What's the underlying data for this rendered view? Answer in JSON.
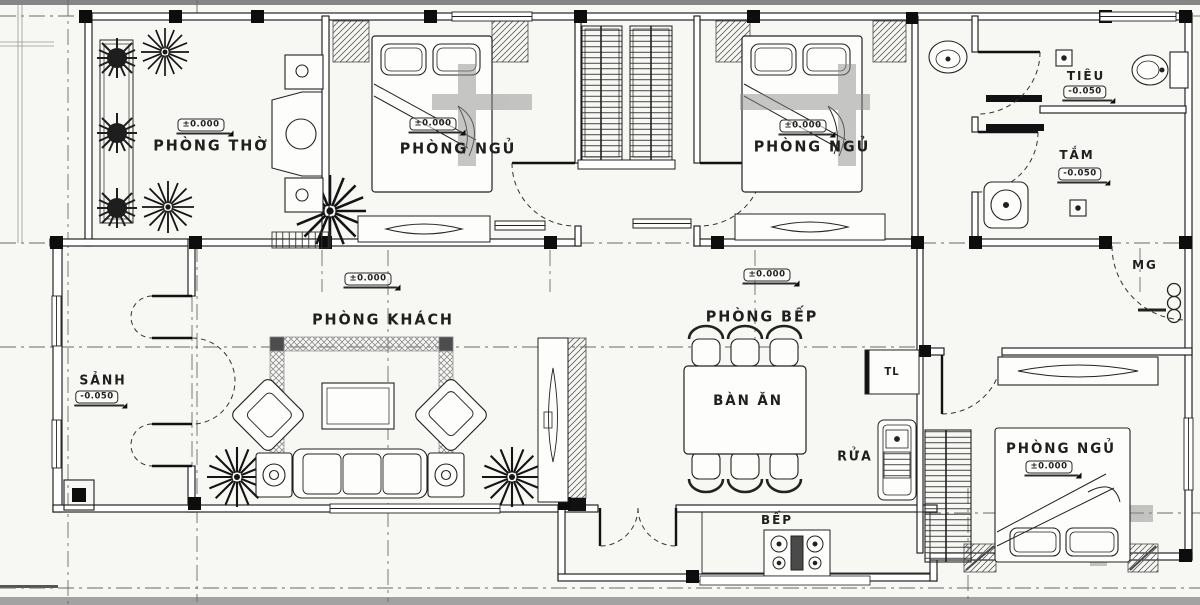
{
  "drawing": {
    "type": "house-floor-plan",
    "colors": {
      "ink": "#1c1c1c",
      "paper": "#f7f7f4",
      "band_top": "#858585",
      "band_bottom": "#a2a2a2",
      "hatch": "#666666",
      "shadow_band": "#8f8f8f"
    }
  },
  "rooms": {
    "phong_tho": {
      "label": "PHÒNG THỜ",
      "level": "±0.000"
    },
    "phong_ngu_1": {
      "label": "PHÒNG NGỦ",
      "level": "±0.000"
    },
    "phong_ngu_2": {
      "label": "PHÒNG NGỦ",
      "level": "±0.000"
    },
    "phong_ngu_3": {
      "label": "PHÒNG NGỦ",
      "level": "±0.000"
    },
    "phong_khach": {
      "label": "PHÒNG KHÁCH",
      "level": "±0.000"
    },
    "phong_bep": {
      "label": "PHÒNG BẾP",
      "level": "±0.000"
    },
    "sanh": {
      "label": "SẢNH",
      "level": "-0.050"
    },
    "tieu": {
      "label": "TIÊU",
      "level": "-0.050"
    },
    "tam": {
      "label": "TẮM",
      "level": "-0.050"
    }
  },
  "fixtures": {
    "ban_an": {
      "label": "BÀN ĂN"
    },
    "bep": {
      "label": "BẾP"
    },
    "rua": {
      "label": "RỬA"
    },
    "tu_lanh": {
      "label": "TL"
    },
    "mg": {
      "label": "MG"
    }
  }
}
